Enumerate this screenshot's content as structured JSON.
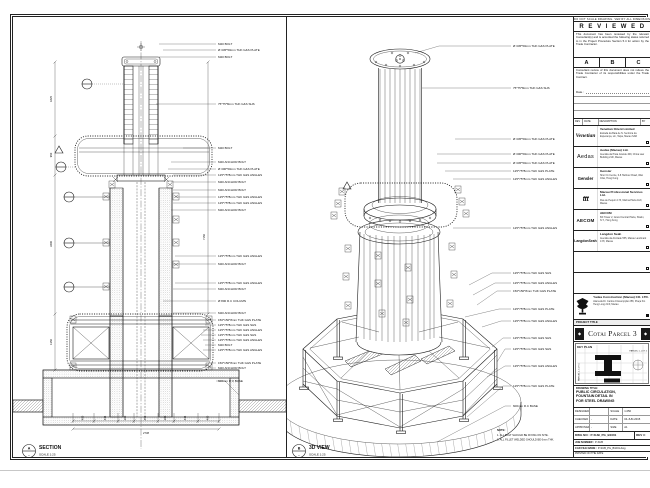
{
  "sheet": {
    "ink": "#1c1c1c",
    "paper": "#ffffff"
  },
  "section": {
    "marker_top": "A",
    "marker_bottom": "-",
    "title": "SECTION",
    "scale": "SCALE 1:25",
    "labels": [
      "M20 BOLT",
      "Ø 345*50mm THK G&S PLATE",
      "M20 BOLT",
      "75*75*8mm THK G&S SHS",
      "M20 BOLT",
      "M20 ANCHOR BOLT",
      "Ø 300*50mm THK G&S PLATE",
      "125*75*8mm THK G&S ANGLES",
      "M20 ANCHOR BOLT",
      "M20 ANCHOR BOLT",
      "125*75*8mm THK G&S ANGLES",
      "125*75*8mm THK G&S ANGLES",
      "M20 ANCHOR BOLT",
      "125*75*8mm THK G&S ANGLES",
      "M20 ANCHOR BOLT",
      "125*75*8mm THK G&S ANGLES",
      "M20 ANCHOR BOLT",
      "Ø 800 R.C COLUMN",
      "M20 ANCHOR BOLT",
      "150*150*8mm THK G&S PLATE",
      "125*75*8mm THK G&S SHS",
      "125*75*8mm THK G&S ANGLES",
      "125*75*8mm THK G&S SHS",
      "125*75*8mm THK G&S ANGLES",
      "M20 BOLT",
      "125*75*8mm THK G&S ANGLES",
      "150*150*8mm THK G&S PLATE",
      "M20 ANCHOR BOLT",
      "600mm R.C BASE"
    ],
    "dims_bottom": [
      "400",
      "444",
      "300",
      "450",
      "300",
      "444",
      "400"
    ],
    "dim_total": "2738",
    "dims_left": [
      "1825",
      "950",
      "3400",
      "1350"
    ],
    "dim_right": "7150"
  },
  "iso": {
    "marker_top": "B",
    "marker_bottom": "-",
    "title": "3D VIEW",
    "scale": "SCALE 1:25",
    "labels": [
      "Ø 345*50mm THK G&S PLATE",
      "75*75*8mm THK G&S SHS",
      "Ø 345*50mm THK G&S PLATE",
      "Ø 300*50mm THK G&S PLATE",
      "Ø 345*50mm THK G&S PLATE",
      "125*75*8mm THK G&S PLATE",
      "125*75*8mm THK G&S ANGLES",
      "125*75*8mm THK G&S ANGLES",
      "125*75*8mm THK G&S SHS",
      "125*75*8mm THK G&S ANGLES",
      "150*150*8mm THK G&S PLATE",
      "125*75*8mm THK G&S PLATE",
      "125*75*8mm THK G&S ANGLES",
      "125*75*8mm THK G&S SHS",
      "125*75*8mm THK G&S SHS",
      "125*75*8mm THK G&S ANGLES",
      "125*75*8mm THK G&S PLATE",
      "600mm R.C BASE"
    ],
    "note_title": "NOTE:",
    "note1": "1. ALL BOLT SHOULD BE FIXING ON SITE.",
    "note2": "2. ALL FILLET WELDED SHOULD BE 6mm THK."
  },
  "titleblock": {
    "edge_note": "DO NOT SCALE DRAWING. VERIFY ALL DIMENSIONS ON SITE.",
    "reviewed": {
      "title": "R E V I E W E D",
      "para1": "This document has been reviewed by the relevant Consultant(s) and is accorded the following status referred to in the Project Procedure Section 5.4 for action by the Trade Contractor.",
      "a": "A",
      "b": "B",
      "c": "C",
      "para2": "Consultant review of this document does not relieve the Trade Contractor of its responsibilities under the Trade Contract.",
      "date_label": "Date :"
    },
    "rev_header": {
      "rev": "REV",
      "date": "DATE",
      "desc": "DESCRIPTION",
      "by": "BY"
    },
    "consultants": [
      {
        "logo": "Venetian",
        "name": "Venetian Orient Limited",
        "addr": "Estrada da Baía de N. Senhora da Esperança, s/n, Taipa, Macau SAR"
      },
      {
        "logo": "Aedas",
        "name": "Aedas (Macau) Ltd.",
        "addr": "Avenida da Praia Grande 409, China Law Building 21/F, Macau"
      },
      {
        "logo": "Gensler",
        "name": "Gensler",
        "addr": "Shui On Centre, 6-8 Harbour Road, Wan Chai, Hong Kong"
      },
      {
        "logo": "ttt",
        "name": "Macau Professional Services Ltd.",
        "addr": "Rua de Pequim 173, Marina Plaza 11/F, Macau"
      },
      {
        "logo": "AECOM",
        "name": "AECOM",
        "addr": "8/F Tower 2, Grand Central Plaza, Shatin, N.T., Hong Kong"
      },
      {
        "logo": "LangdonSeah",
        "name": "Langdon Seah",
        "addr": "Avenida da Amizade 555, Macau Landmark 17/F, Macau"
      }
    ],
    "contractor": {
      "name": "Yadea Construction (Macau) CO. LTD.",
      "addr": "Alameda Dr. Carlos d'Assumpção 258, Praça Kin Heng Long 21/F, Macau"
    },
    "project": {
      "bar": "PROJECT TITLE",
      "name": "Cotai Parcel 3"
    },
    "keyplan": {
      "label": "KEY PLAN",
      "right": "PARCEL 1, LOT 2",
      "left": "PARCEL 1, LOT 1"
    },
    "drawing": {
      "label": "DRAWING TITLE:",
      "line1": "PUBLIC CIRCULATION,",
      "line2": "FOUNTAIN DETAIL IN",
      "line3": "FOR STEEL DRAWING"
    },
    "approvals": {
      "r1l": "DESIGNED",
      "r1v": "",
      "r1l2": "SCALE",
      "r1v2": "1:250",
      "r2l": "CHECKED",
      "r2v": "-",
      "r2l2": "DATE",
      "r2v2": "04-JUN-2015",
      "r3l": "APPROVED",
      "r3v": "-",
      "r3l2": "SIZE",
      "r3v2": "A1"
    },
    "dwg": {
      "label": "DWG NO :",
      "no": "P-SUB_PG_B1001",
      "rev_label": "REV",
      "rev": "C"
    },
    "job": {
      "label": "JOB NUMBER :",
      "value": "P-SUB"
    },
    "cad": {
      "label": "CAD FILE NAME :",
      "value": "P-SUB_PG_B1001.dwg"
    },
    "printed": {
      "label": "PRINTED ON THE DATE"
    }
  }
}
